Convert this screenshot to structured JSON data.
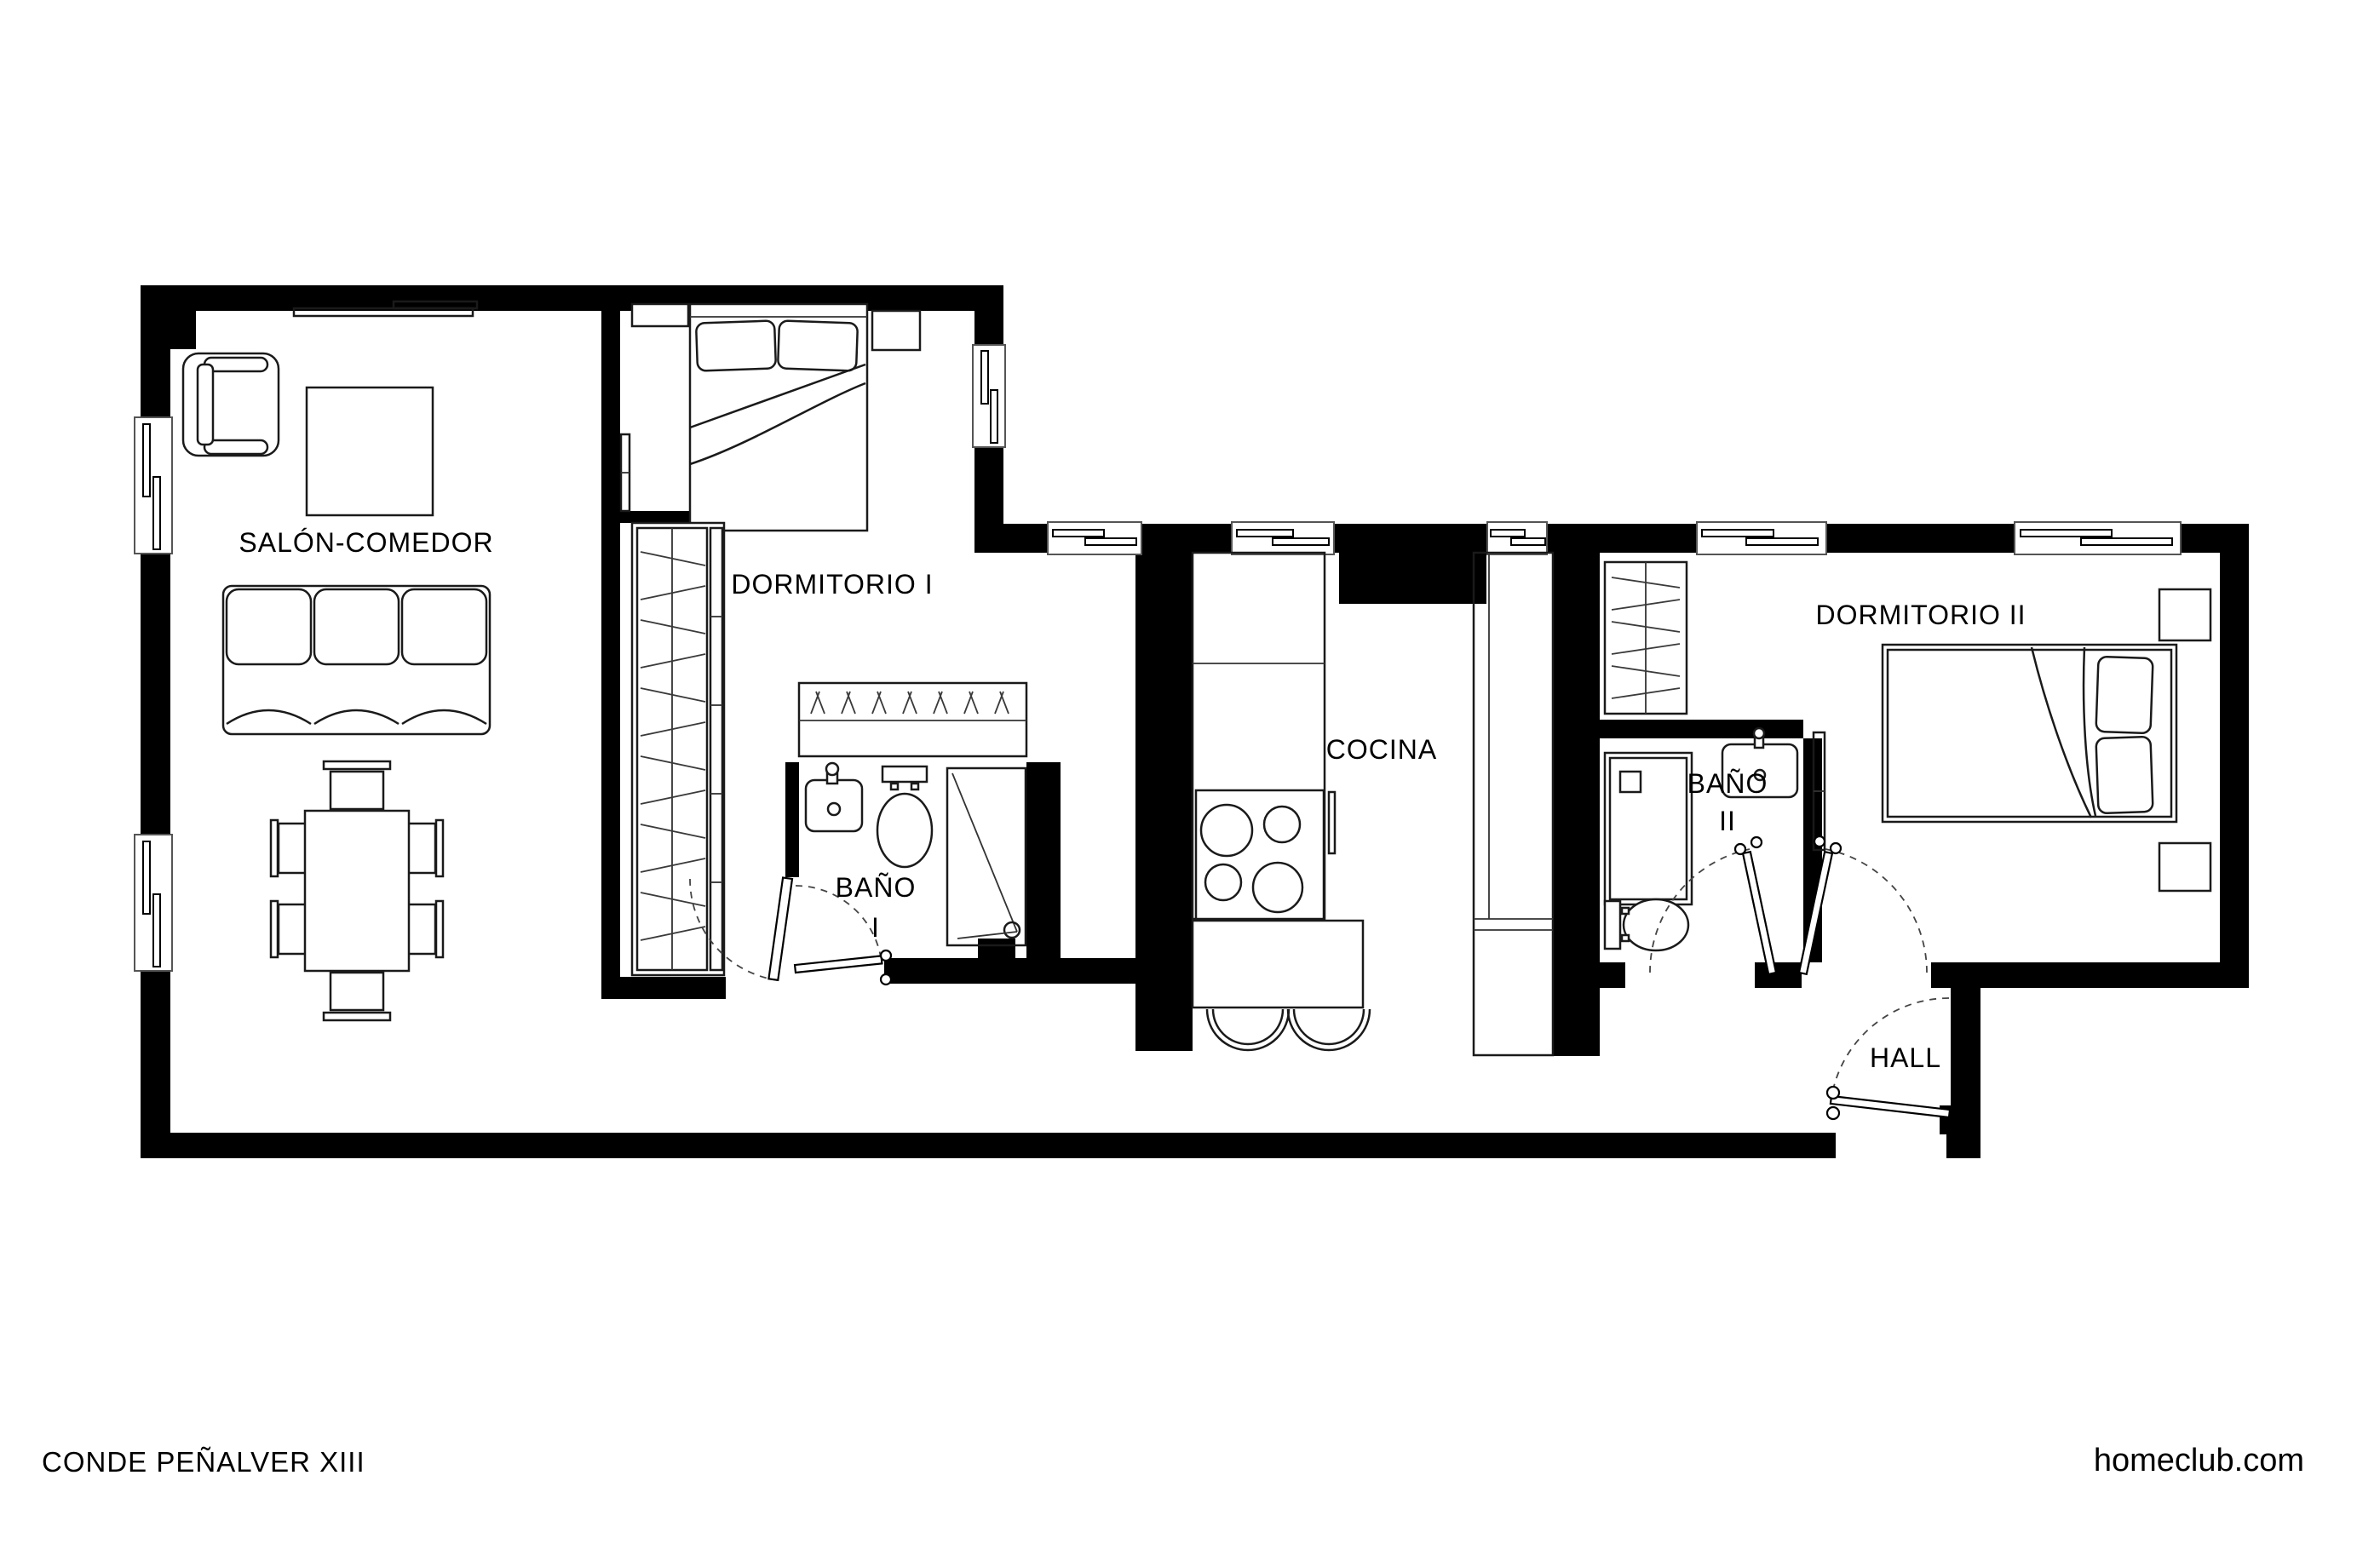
{
  "document": {
    "title": "CONDE PEÑALVER XIII",
    "website": "homeclub.com",
    "type": "apartment floor plan"
  },
  "colors": {
    "walls": "#000000",
    "background": "#ffffff",
    "linework": "#1a1a1a"
  },
  "floorplan": {
    "rooms": [
      {
        "id": "salon-comedor",
        "label": "SALÓN-COMEDOR",
        "furniture": [
          "armchair",
          "side-table",
          "sofa-3-seats",
          "tv-shelf",
          "dining-table",
          "six-dining-chairs"
        ]
      },
      {
        "id": "dormitorio-1",
        "label": "DORMITORIO I",
        "furniture": [
          "double-bed",
          "two-pillows",
          "nightstand",
          "dresser",
          "radiator",
          "built-in-wardrobe"
        ]
      },
      {
        "id": "bano-1",
        "label": "BAÑO I",
        "label_lines": [
          "BAÑO",
          "I"
        ],
        "fixtures": [
          "washbasin",
          "toilet",
          "shower",
          "wardrobe"
        ]
      },
      {
        "id": "cocina",
        "label": "COCINA",
        "fixtures": [
          "counter",
          "cooktop-4-burners",
          "island-breakfast-bar",
          "two-stools",
          "tall-units"
        ]
      },
      {
        "id": "bano-2",
        "label": "BAÑO II",
        "label_lines": [
          "BAÑO",
          "II"
        ],
        "fixtures": [
          "wardrobe",
          "shower",
          "washbasin",
          "toilet"
        ]
      },
      {
        "id": "dormitorio-2",
        "label": "DORMITORIO II",
        "furniture": [
          "double-bed",
          "two-pillows",
          "two-nightstands",
          "radiator"
        ]
      },
      {
        "id": "hall",
        "label": "HALL",
        "features": [
          "entry-door"
        ]
      }
    ],
    "openings": {
      "windows": 8,
      "doors": [
        "bano-1-door",
        "dormitorio-1-passage-door",
        "bano-2-door",
        "dormitorio-2-door",
        "entry-door"
      ]
    }
  }
}
